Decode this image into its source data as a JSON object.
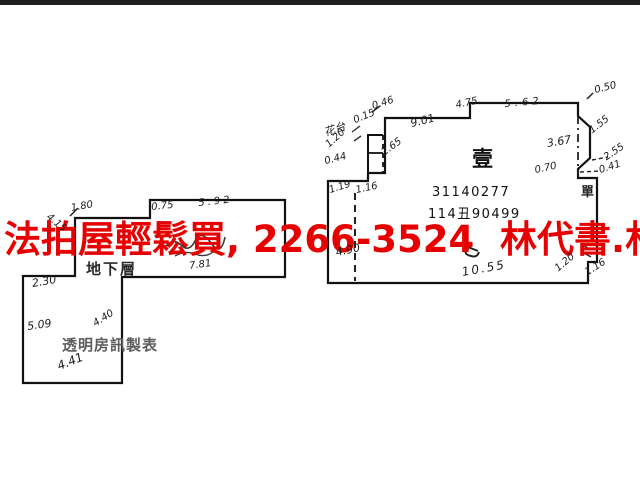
{
  "watermark": {
    "text": "法拍屋輕鬆買, 2266-3524  林代書.林經理",
    "color": "#e60000"
  },
  "left_unit": {
    "floor_label": "地下層",
    "maker_label": "透明房訊製表",
    "m": {
      "lm_180": "1.80",
      "lm_415": "4.15",
      "lm_075": "0.75",
      "lm_592": "5.92",
      "lm_781": "7.81",
      "lm_230": "2.30",
      "lm_509": "5.09",
      "lm_440": "4.40",
      "lm_441": "4.41"
    }
  },
  "right_unit": {
    "unit_label": "壹",
    "serial_1": "31140277",
    "serial_2": "114丑90499",
    "box_label": "單",
    "m": {
      "rm_046": "0.46",
      "rm_015": "0.15",
      "rm_flower": "花台",
      "rm_120a": "1.20",
      "rm_044": "0.44",
      "rm_265": "2.65",
      "rm_901": "9.01",
      "rm_475": "4.75",
      "rm_562": "5.62",
      "rm_050": "0.50",
      "rm_367": "3.67",
      "rm_155": "1.55",
      "rm_255": "2.55",
      "rm_070": "0.70",
      "rm_041": "0.41",
      "rm_119": "1.19",
      "rm_116a": "1.16",
      "rm_490": "4.90",
      "rm_1055": "10.55",
      "rm_120b": "1.20",
      "rm_116b": "1.16"
    }
  }
}
